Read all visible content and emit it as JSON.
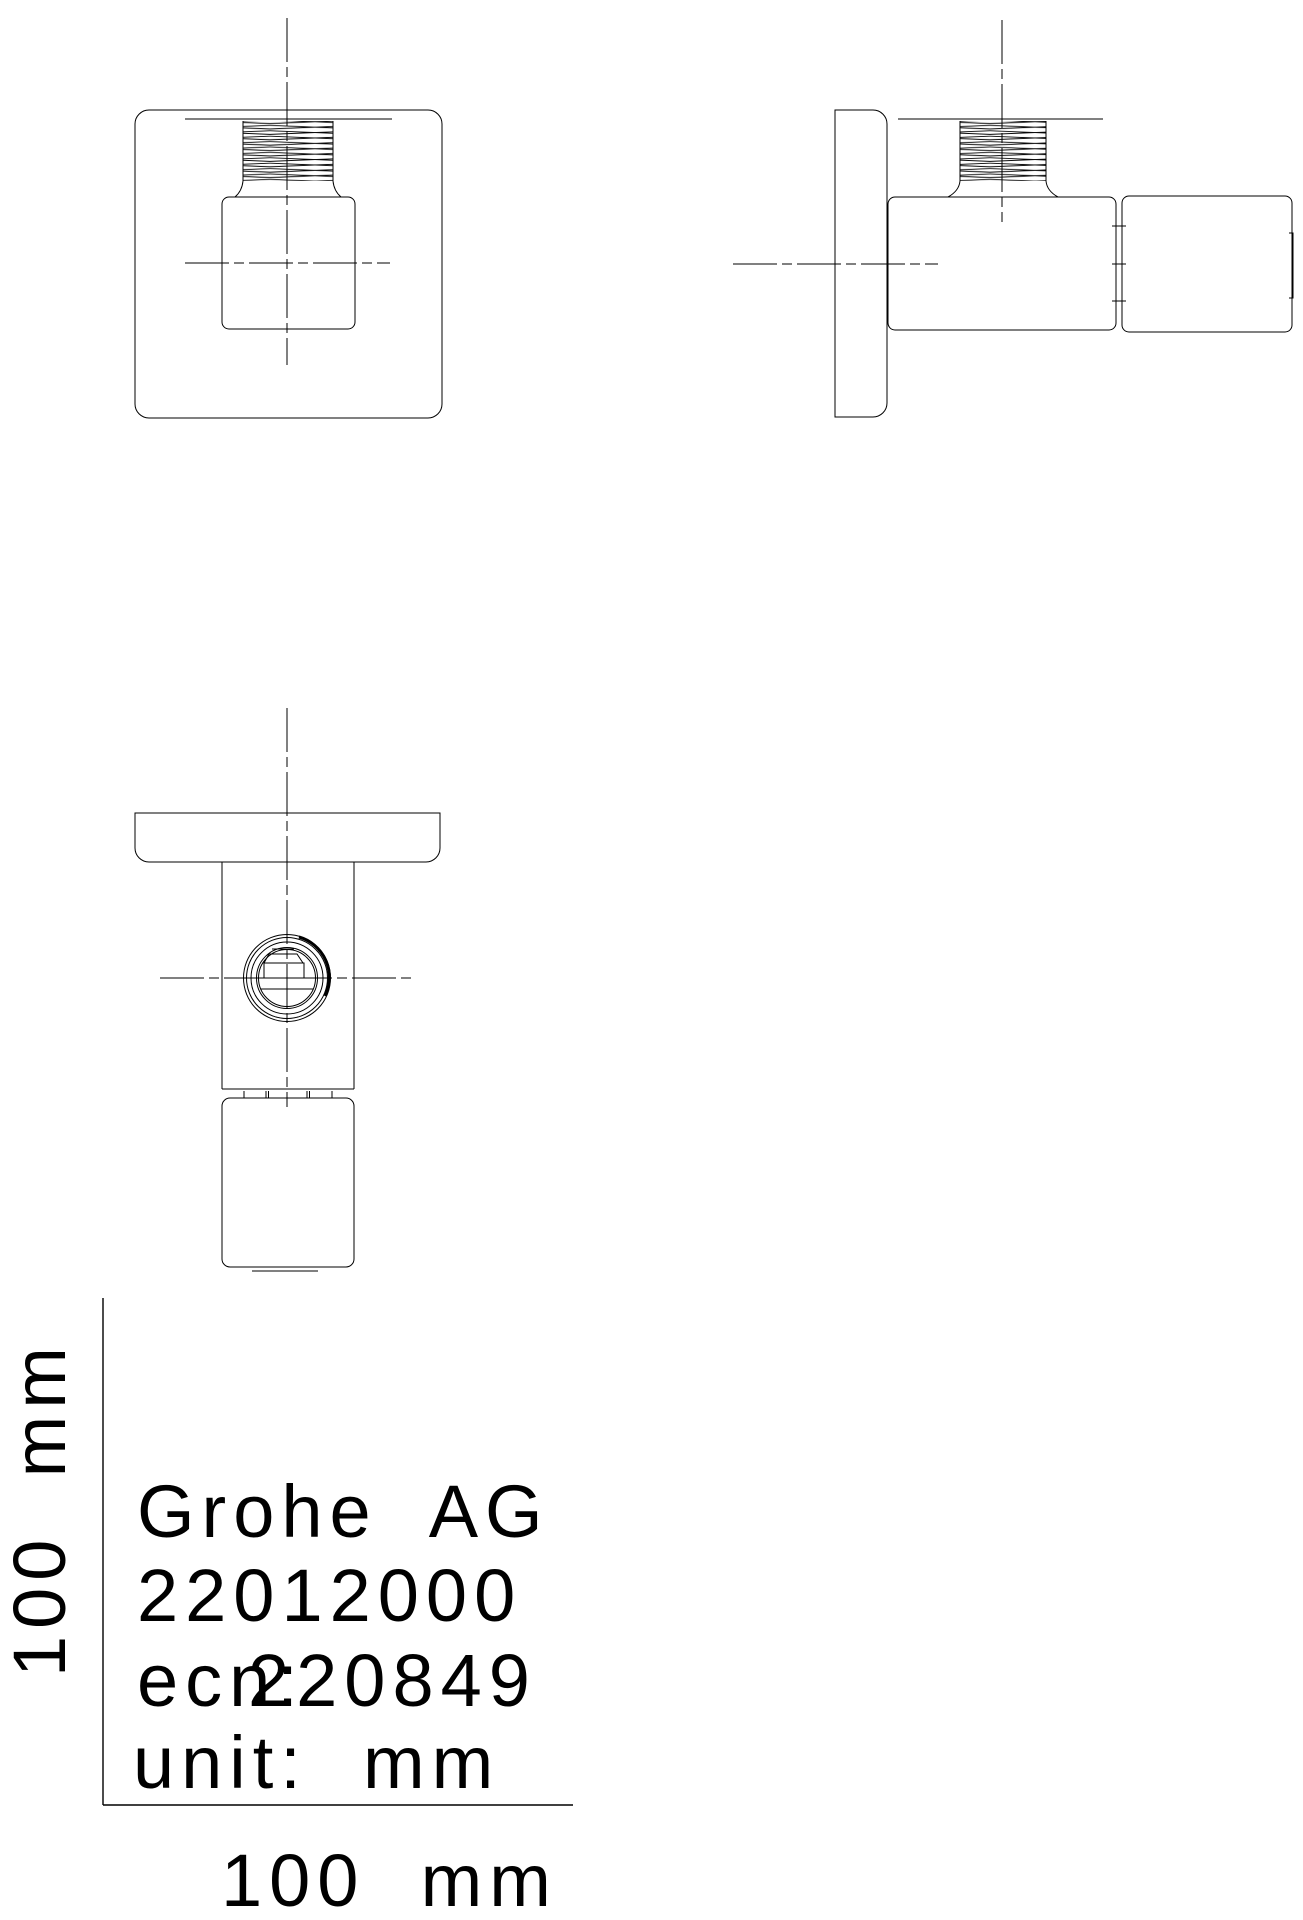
{
  "colors": {
    "background": "#ffffff",
    "line": "#000000"
  },
  "title_block": {
    "company": "Grohe  AG",
    "product_number": "22012000",
    "ecn_label": "ecn:",
    "ecn_number": "220849",
    "unit_line": "unit:  mm"
  },
  "scale": {
    "vertical_label": "100  mm",
    "horizontal_label": "100  mm"
  }
}
